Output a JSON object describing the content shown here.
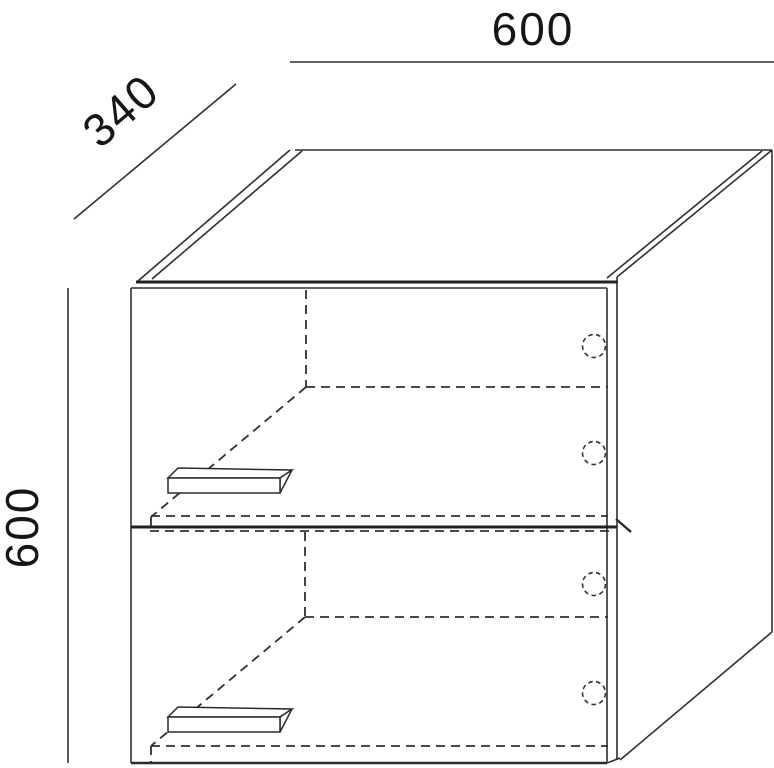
{
  "drawing": {
    "dimension_labels": {
      "width_mm": "600",
      "depth_mm": "340",
      "height_mm": "600"
    },
    "colors": {
      "line": "#2f2f2f",
      "background": "#ffffff"
    }
  }
}
